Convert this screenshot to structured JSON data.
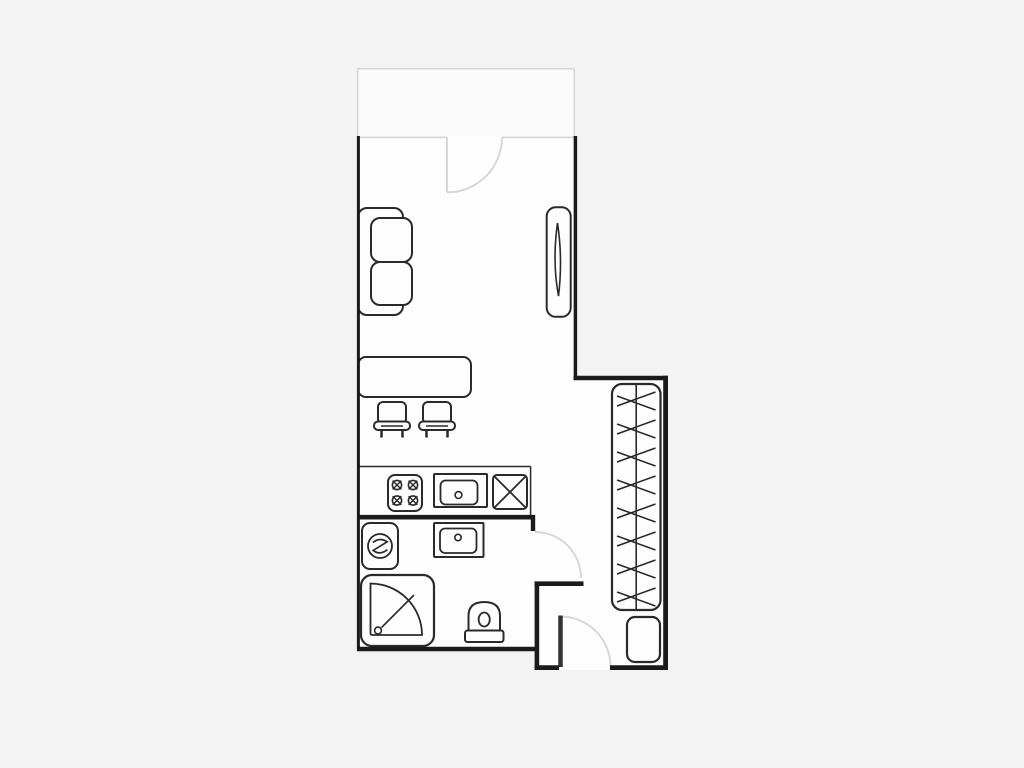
{
  "canvas": {
    "width": 1024,
    "height": 768
  },
  "palette": {
    "bg": "#f3f3f4",
    "room": "#fdfdfd",
    "balcony": "#fbfbfb",
    "wall": "#1b1b1d",
    "furn": "#2a2a2c",
    "light": "#d7d7d9",
    "leaf": "#323234"
  },
  "shapes": [
    {
      "n": "apartment-floor",
      "t": "polygon",
      "pts": "357,136 577.3,136 577.3,375.7 668,375.7 668,670 534.7,670 534.7,651.3 357,651.3",
      "f": "room"
    },
    {
      "n": "balcony-floor",
      "t": "rect",
      "x": 357.7,
      "y": 68.7,
      "wd": 216.6,
      "ht": 68.3,
      "f": "balcony"
    },
    {
      "n": "balcony-outline",
      "t": "path",
      "dd": "M 357.7 137 L 357.7 68.7 L 574.3 68.7 L 574.3 137",
      "s": "light",
      "w": 1.6
    },
    {
      "n": "room-top-wall",
      "t": "line",
      "x1": 357,
      "y1": 137.4,
      "x2": 447,
      "y2": 137.4,
      "s": "light",
      "w": 1.8
    },
    {
      "n": "room-top-wall",
      "t": "line",
      "x1": 502,
      "y1": 137.4,
      "x2": 575.5,
      "y2": 137.4,
      "s": "light",
      "w": 1.8
    },
    {
      "n": "balcony-door-leaf",
      "t": "line",
      "x1": 447,
      "y1": 137.4,
      "x2": 447,
      "y2": 192,
      "s": "light",
      "w": 2
    },
    {
      "n": "balcony-door-swing",
      "t": "path",
      "dd": "M 502 137.4 A 55 55 0 0 1 447 192.4",
      "s": "light",
      "w": 2
    },
    {
      "n": "kitchen-counter-edge",
      "t": "line",
      "x1": 358.5,
      "y1": 466.5,
      "x2": 530.6,
      "y2": 466.5,
      "s": "furn",
      "w": 1.5
    },
    {
      "n": "kitchen-counter-edge",
      "t": "line",
      "x1": 530.6,
      "y1": 466.5,
      "x2": 530.6,
      "y2": 515,
      "s": "furn",
      "w": 1.5
    },
    {
      "n": "sofa-backrest",
      "t": "rect",
      "x": 358,
      "y": 208,
      "wd": 45,
      "ht": 107,
      "rx": 9,
      "s": "furn",
      "w": 2,
      "f": "room"
    },
    {
      "n": "sofa-cushion",
      "t": "rect",
      "x": 371,
      "y": 218,
      "wd": 41,
      "ht": 44,
      "rx": 9,
      "s": "furn",
      "w": 2,
      "f": "room"
    },
    {
      "n": "sofa-cushion",
      "t": "rect",
      "x": 371,
      "y": 262,
      "wd": 41,
      "ht": 43,
      "rx": 9,
      "s": "furn",
      "w": 2,
      "f": "room"
    },
    {
      "n": "window-frame",
      "t": "rect",
      "x": 546.7,
      "y": 207.3,
      "wd": 24,
      "ht": 109.5,
      "rx": 9,
      "s": "furn",
      "w": 2,
      "f": "room"
    },
    {
      "n": "window-lens",
      "t": "path",
      "dd": "M 557.5 223 C 554 248 554 272 558.5 296 C 561.5 271 561 246 557.5 223 Z",
      "s": "furn",
      "w": 1.6
    },
    {
      "n": "dining-table",
      "t": "rect",
      "x": 358,
      "y": 357,
      "wd": 113,
      "ht": 40,
      "rx": 8,
      "s": "furn",
      "w": 2,
      "f": "room"
    },
    {
      "n": "stool-seat",
      "t": "rect",
      "x": 378,
      "y": 402,
      "wd": 28,
      "ht": 22,
      "rx": 5,
      "s": "furn",
      "w": 2,
      "f": "room"
    },
    {
      "n": "stool-base",
      "t": "rect",
      "x": 374,
      "y": 421.5,
      "wd": 36,
      "ht": 8.5,
      "rx": 4,
      "s": "furn",
      "w": 2,
      "f": "room"
    },
    {
      "n": "stool-base-detail",
      "t": "line",
      "x1": 381,
      "y1": 426,
      "x2": 403,
      "y2": 426,
      "s": "furn",
      "w": 1.5
    },
    {
      "n": "stool-leg",
      "t": "line",
      "x1": 381.5,
      "y1": 430,
      "x2": 381.5,
      "y2": 437.5,
      "s": "furn",
      "w": 2.5
    },
    {
      "n": "stool-leg",
      "t": "line",
      "x1": 402.5,
      "y1": 430,
      "x2": 402.5,
      "y2": 437.5,
      "s": "furn",
      "w": 2.5
    },
    {
      "n": "stool-seat",
      "t": "rect",
      "x": 423,
      "y": 402,
      "wd": 28,
      "ht": 22,
      "rx": 5,
      "s": "furn",
      "w": 2,
      "f": "room"
    },
    {
      "n": "stool-base",
      "t": "rect",
      "x": 419,
      "y": 421.5,
      "wd": 36,
      "ht": 8.5,
      "rx": 4,
      "s": "furn",
      "w": 2,
      "f": "room"
    },
    {
      "n": "stool-base-detail",
      "t": "line",
      "x1": 426,
      "y1": 426,
      "x2": 448,
      "y2": 426,
      "s": "furn",
      "w": 1.5
    },
    {
      "n": "stool-leg",
      "t": "line",
      "x1": 426.5,
      "y1": 430,
      "x2": 426.5,
      "y2": 437.5,
      "s": "furn",
      "w": 2.5
    },
    {
      "n": "stool-leg",
      "t": "line",
      "x1": 447.5,
      "y1": 430,
      "x2": 447.5,
      "y2": 437.5,
      "s": "furn",
      "w": 2.5
    },
    {
      "n": "stove",
      "t": "rect",
      "x": 388,
      "y": 475,
      "wd": 34,
      "ht": 36,
      "rx": 7,
      "s": "furn",
      "w": 2,
      "f": "room"
    },
    {
      "n": "burner",
      "t": "circle",
      "cx": 397,
      "cy": 485,
      "r": 4.6,
      "s": "furn",
      "w": 1.6
    },
    {
      "n": "burner-cross",
      "t": "path",
      "dd": "M 392.6 480.6 L 401.4 489.4 M 401.4 480.6 L 392.6 489.4",
      "s": "furn",
      "w": 1.4
    },
    {
      "n": "burner",
      "t": "circle",
      "cx": 413,
      "cy": 485,
      "r": 4.6,
      "s": "furn",
      "w": 1.6
    },
    {
      "n": "burner-cross",
      "t": "path",
      "dd": "M 408.6 480.6 L 417.4 489.4 M 417.4 480.6 L 408.6 489.4",
      "s": "furn",
      "w": 1.4
    },
    {
      "n": "burner",
      "t": "circle",
      "cx": 397,
      "cy": 500.5,
      "r": 4.6,
      "s": "furn",
      "w": 1.6
    },
    {
      "n": "burner-cross",
      "t": "path",
      "dd": "M 392.6 496.1 L 401.4 504.9 M 401.4 496.1 L 392.6 504.9",
      "s": "furn",
      "w": 1.4
    },
    {
      "n": "burner",
      "t": "circle",
      "cx": 413,
      "cy": 500.5,
      "r": 4.6,
      "s": "furn",
      "w": 1.6
    },
    {
      "n": "burner-cross",
      "t": "path",
      "dd": "M 408.6 496.1 L 417.4 504.9 M 417.4 496.1 L 408.6 504.9",
      "s": "furn",
      "w": 1.4
    },
    {
      "n": "kitchen-sink",
      "t": "rect",
      "x": 434,
      "y": 474,
      "wd": 53,
      "ht": 33,
      "rx": 1,
      "s": "furn",
      "w": 2,
      "f": "room"
    },
    {
      "n": "kitchen-sink-basin",
      "t": "rect",
      "x": 440.5,
      "y": 480.5,
      "wd": 37,
      "ht": 24,
      "rx": 5,
      "s": "furn",
      "w": 1.8
    },
    {
      "n": "kitchen-sink-drain",
      "t": "circle",
      "cx": 458.5,
      "cy": 495,
      "r": 3.4,
      "s": "furn",
      "w": 1.6
    },
    {
      "n": "kitchen-cabinet",
      "t": "rect",
      "x": 493,
      "y": 475,
      "wd": 34,
      "ht": 34,
      "rx": 4,
      "s": "furn",
      "w": 2,
      "f": "room"
    },
    {
      "n": "kitchen-cabinet-cross",
      "t": "path",
      "dd": "M 494.6 476.6 L 525.4 507.4 M 525.4 476.6 L 494.6 507.4",
      "s": "furn",
      "w": 1.8
    },
    {
      "n": "washing-machine",
      "t": "rect",
      "x": 362,
      "y": 523,
      "wd": 36,
      "ht": 46,
      "rx": 8,
      "s": "furn",
      "w": 2,
      "f": "room"
    },
    {
      "n": "washing-machine-drum",
      "t": "circle",
      "cx": 380,
      "cy": 546,
      "r": 12,
      "s": "furn",
      "w": 1.8
    },
    {
      "n": "washing-machine-symbol",
      "t": "path",
      "dd": "M 372.8 542.5 Q 380 536.8 387.2 541.8 L 373.2 550.4 Q 380 555.6 387.4 549.6",
      "s": "furn",
      "w": 1.7
    },
    {
      "n": "bathroom-sink",
      "t": "rect",
      "x": 434,
      "y": 523,
      "wd": 49.5,
      "ht": 34,
      "rx": 1,
      "s": "furn",
      "w": 2,
      "f": "room"
    },
    {
      "n": "bathroom-sink-basin",
      "t": "rect",
      "x": 440,
      "y": 528.5,
      "wd": 36.5,
      "ht": 24.5,
      "rx": 5,
      "s": "furn",
      "w": 1.8
    },
    {
      "n": "bathroom-sink-drain",
      "t": "circle",
      "cx": 458,
      "cy": 537.5,
      "r": 3.2,
      "s": "furn",
      "w": 1.6
    },
    {
      "n": "shower-cabin",
      "t": "rect",
      "x": 361,
      "y": 575,
      "wd": 73,
      "ht": 71,
      "rx": 11,
      "s": "furn",
      "w": 2.2,
      "f": "room"
    },
    {
      "n": "shower-tray",
      "t": "path",
      "dd": "M 370.5 583.5 A 51.5 51.5 0 0 1 422 635 L 372.5 635 Q 370.5 635 370.5 633 Z",
      "s": "furn",
      "w": 1.8
    },
    {
      "n": "shower-line",
      "t": "line",
      "x1": 381.5,
      "y1": 627.5,
      "x2": 414,
      "y2": 595,
      "s": "furn",
      "w": 1.6
    },
    {
      "n": "shower-drain",
      "t": "circle",
      "cx": 378,
      "cy": 630.5,
      "r": 3.4,
      "s": "furn",
      "w": 1.6,
      "f": "room"
    },
    {
      "n": "toilet-bowl",
      "t": "path",
      "dd": "M 468.5 631 L 468.5 616 Q 468.5 602 484.2 602 Q 500 602 500 616 L 500 631 Z",
      "s": "furn",
      "w": 2,
      "f": "room"
    },
    {
      "n": "toilet-drain",
      "t": "ellipse",
      "cx": 484.2,
      "cy": 619.5,
      "rx": 5.6,
      "ry": 7,
      "s": "furn",
      "w": 1.8
    },
    {
      "n": "toilet-cistern",
      "t": "rect",
      "x": 465,
      "y": 630.5,
      "wd": 38.5,
      "ht": 11.5,
      "rx": 2.5,
      "s": "furn",
      "w": 2,
      "f": "room"
    },
    {
      "n": "wardrobe",
      "t": "rect",
      "x": 612,
      "y": 384,
      "wd": 48.5,
      "ht": 226,
      "rx": 10,
      "s": "furn",
      "w": 2.2,
      "f": "room"
    },
    {
      "n": "wardrobe-rail",
      "t": "line",
      "x1": 636.2,
      "y1": 384,
      "x2": 636.2,
      "y2": 610,
      "s": "furn",
      "w": 1.6
    },
    {
      "n": "hanger",
      "t": "line",
      "x1": 617,
      "y1": 406,
      "x2": 655.5,
      "y2": 392,
      "s": "furn",
      "w": 1.6
    },
    {
      "n": "hanger",
      "t": "line",
      "x1": 617,
      "y1": 396,
      "x2": 655.5,
      "y2": 410,
      "s": "furn",
      "w": 1.6
    },
    {
      "n": "hanger",
      "t": "line",
      "x1": 617,
      "y1": 434,
      "x2": 655.5,
      "y2": 420,
      "s": "furn",
      "w": 1.6
    },
    {
      "n": "hanger",
      "t": "line",
      "x1": 617,
      "y1": 424,
      "x2": 655.5,
      "y2": 438,
      "s": "furn",
      "w": 1.6
    },
    {
      "n": "hanger",
      "t": "line",
      "x1": 617,
      "y1": 462,
      "x2": 655.5,
      "y2": 448,
      "s": "furn",
      "w": 1.6
    },
    {
      "n": "hanger",
      "t": "line",
      "x1": 617,
      "y1": 452,
      "x2": 655.5,
      "y2": 466,
      "s": "furn",
      "w": 1.6
    },
    {
      "n": "hanger",
      "t": "line",
      "x1": 617,
      "y1": 490,
      "x2": 655.5,
      "y2": 476,
      "s": "furn",
      "w": 1.6
    },
    {
      "n": "hanger",
      "t": "line",
      "x1": 617,
      "y1": 480,
      "x2": 655.5,
      "y2": 494,
      "s": "furn",
      "w": 1.6
    },
    {
      "n": "hanger",
      "t": "line",
      "x1": 617,
      "y1": 518,
      "x2": 655.5,
      "y2": 504,
      "s": "furn",
      "w": 1.6
    },
    {
      "n": "hanger",
      "t": "line",
      "x1": 617,
      "y1": 508,
      "x2": 655.5,
      "y2": 522,
      "s": "furn",
      "w": 1.6
    },
    {
      "n": "hanger",
      "t": "line",
      "x1": 617,
      "y1": 546,
      "x2": 655.5,
      "y2": 532,
      "s": "furn",
      "w": 1.6
    },
    {
      "n": "hanger",
      "t": "line",
      "x1": 617,
      "y1": 536,
      "x2": 655.5,
      "y2": 550,
      "s": "furn",
      "w": 1.6
    },
    {
      "n": "hanger",
      "t": "line",
      "x1": 617,
      "y1": 574,
      "x2": 655.5,
      "y2": 560,
      "s": "furn",
      "w": 1.6
    },
    {
      "n": "hanger",
      "t": "line",
      "x1": 617,
      "y1": 564,
      "x2": 655.5,
      "y2": 578,
      "s": "furn",
      "w": 1.6
    },
    {
      "n": "hanger",
      "t": "line",
      "x1": 617,
      "y1": 602,
      "x2": 655.5,
      "y2": 588,
      "s": "furn",
      "w": 1.6
    },
    {
      "n": "hanger",
      "t": "line",
      "x1": 617,
      "y1": 592,
      "x2": 655.5,
      "y2": 606,
      "s": "furn",
      "w": 1.6
    },
    {
      "n": "entry-cabinet",
      "t": "rect",
      "x": 627,
      "y": 617,
      "wd": 33,
      "ht": 45,
      "rx": 8,
      "s": "furn",
      "w": 2.2,
      "f": "room"
    },
    {
      "n": "bathroom-door-swing",
      "t": "path",
      "dd": "M 535 532 A 46 46 0 0 1 581 578",
      "s": "light",
      "w": 2
    },
    {
      "n": "entry-door-swing",
      "t": "path",
      "dd": "M 560.5 616.5 A 50 50 0 0 1 610.5 666.5",
      "s": "light",
      "w": 2
    },
    {
      "n": "entry-door-leaf",
      "t": "line",
      "x1": 560.5,
      "y1": 615.5,
      "x2": 560.5,
      "y2": 667,
      "s": "leaf",
      "w": 4.5
    },
    {
      "n": "wall-left",
      "t": "line",
      "x1": 358.4,
      "y1": 136,
      "x2": 358.4,
      "y2": 651,
      "s": "wall",
      "w": 3
    },
    {
      "n": "wall-right-upper",
      "t": "line",
      "x1": 575.4,
      "y1": 136,
      "x2": 575.4,
      "y2": 378,
      "s": "wall",
      "w": 3.5
    },
    {
      "n": "wall-shelf",
      "t": "line",
      "x1": 573.5,
      "y1": 378,
      "x2": 668,
      "y2": 378,
      "s": "wall",
      "w": 4.5
    },
    {
      "n": "wall-right-lower",
      "t": "line",
      "x1": 665.6,
      "y1": 375.8,
      "x2": 665.6,
      "y2": 670,
      "s": "wall",
      "w": 4.8
    },
    {
      "n": "wall-bottom-right",
      "t": "line",
      "x1": 610,
      "y1": 667.6,
      "x2": 668,
      "y2": 667.6,
      "s": "wall",
      "w": 4.8
    },
    {
      "n": "wall-bottom-left",
      "t": "line",
      "x1": 534.6,
      "y1": 667.6,
      "x2": 559,
      "y2": 667.6,
      "s": "wall",
      "w": 4.8
    },
    {
      "n": "wall-vestibule",
      "t": "line",
      "x1": 536.9,
      "y1": 581.5,
      "x2": 536.9,
      "y2": 670,
      "s": "wall",
      "w": 4.6
    },
    {
      "n": "wall-vestibule-stub",
      "t": "line",
      "x1": 534.6,
      "y1": 583.7,
      "x2": 583.5,
      "y2": 583.7,
      "s": "wall",
      "w": 4.6
    },
    {
      "n": "wall-bathroom-bottom",
      "t": "line",
      "x1": 357,
      "y1": 649,
      "x2": 539,
      "y2": 649,
      "s": "wall",
      "w": 4.6
    },
    {
      "n": "wall-bathroom-top",
      "t": "line",
      "x1": 357,
      "y1": 517.2,
      "x2": 535,
      "y2": 517.2,
      "s": "wall",
      "w": 4.6
    },
    {
      "n": "wall-kitchen-stub",
      "t": "line",
      "x1": 533,
      "y1": 515,
      "x2": 533,
      "y2": 531,
      "s": "wall",
      "w": 4.4
    }
  ]
}
